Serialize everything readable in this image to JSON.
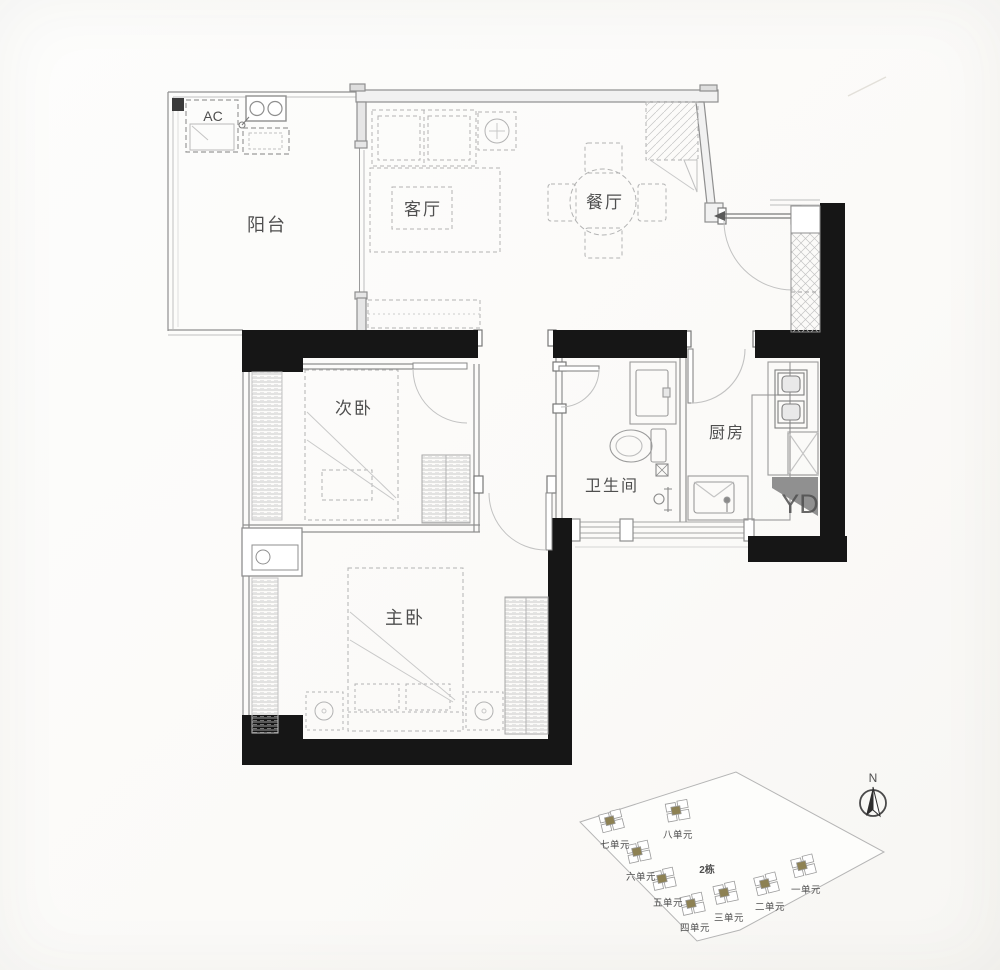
{
  "colors": {
    "wall_black": "#161616",
    "wall_gray": "#8a8a8a",
    "wall_fill": "#f1f1f1",
    "furniture_gray": "#b3b3b3",
    "text_gray": "#4f4f4f",
    "accent_olive": "#a0913c",
    "site_line": "#b5b5b5",
    "watermark_gray": "#cdd0d4"
  },
  "floor_plan": {
    "rooms": {
      "balcony": {
        "label": "阳台"
      },
      "living_room": {
        "label": "客厅"
      },
      "dining_room": {
        "label": "餐厅"
      },
      "second_bedroom": {
        "label": "次卧"
      },
      "bathroom": {
        "label": "卫生间"
      },
      "kitchen": {
        "label": "厨房"
      },
      "master_bedroom": {
        "label": "主卧"
      }
    },
    "labels": {
      "ac": "AC",
      "watermark": "YD"
    }
  },
  "site_plan": {
    "building": "2栋",
    "north": "N",
    "units": [
      {
        "label": "一单元"
      },
      {
        "label": "二单元"
      },
      {
        "label": "三单元"
      },
      {
        "label": "四单元"
      },
      {
        "label": "五单元"
      },
      {
        "label": "六单元"
      },
      {
        "label": "七单元"
      },
      {
        "label": "八单元"
      }
    ]
  }
}
